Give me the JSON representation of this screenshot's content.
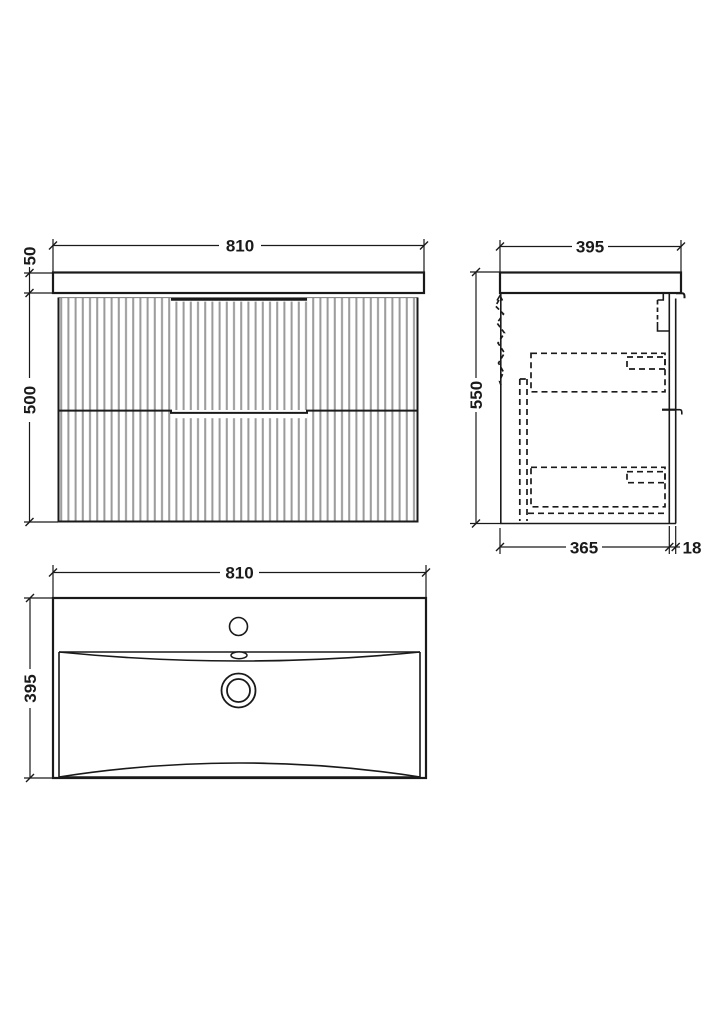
{
  "colors": {
    "line": "#1a1a1a",
    "flute": "#9a9a9a",
    "background": "#ffffff"
  },
  "views": {
    "front": {
      "width": "810",
      "counter_thickness": "50",
      "cabinet_height": "500"
    },
    "side": {
      "depth": "395",
      "overall_height": "550",
      "cabinet_depth": "365",
      "front_panel_thickness": "18"
    },
    "basin_plan": {
      "width": "810",
      "depth": "395"
    }
  }
}
